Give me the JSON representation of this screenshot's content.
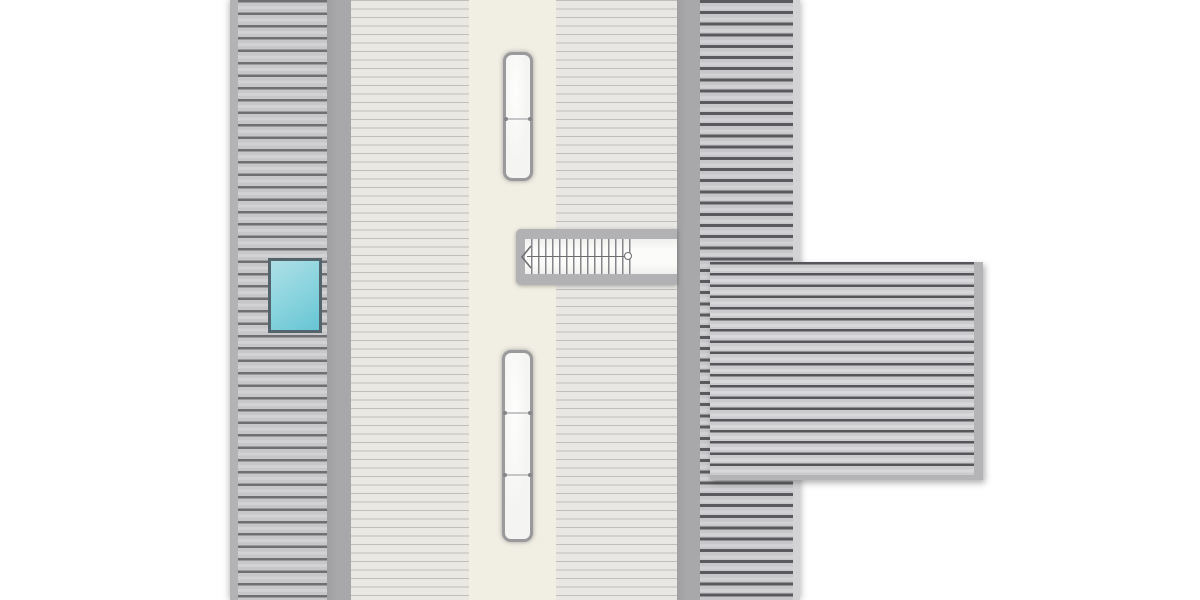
{
  "document": {
    "kind": "architectural-roof-plan",
    "description": "Top-down roof plan of a T-shaped house: long gabled main roof with ridge running vertically, hatched left and right slopes, a side wing roof extending right, one cyan skylight on the left slope, two white ridge roof-windows, and a staircase symbol with walkline, start circle and direction arrow.",
    "visible_text": []
  },
  "colors": {
    "canvas_bg": "#ffffff",
    "eave_left": "#b3b3b5",
    "eave_right": "#d3d3d5",
    "ridge_band_side": "#a8a8aa",
    "ridge_band_center": "#f1efe4",
    "slope_hatch_fill": "#c7c7c9",
    "slope_hatch_line": "#6f6f73",
    "slope_hatch_line_dark": "#5a5a5e",
    "cream_slope_fill": "#eae8e2",
    "cream_slope_fill2": "#e9e7e3",
    "cream_slope_line": "#c0beb8",
    "wing_fill": "#cbcbcd",
    "wing_line": "#56565a",
    "wing_edge": "#b4b4b6",
    "skylight_top": "#aedfe6",
    "skylight_bottom": "#66c5d4",
    "skylight_border": "#53646c",
    "window_fill": "#f4f4f2",
    "window_border": "#9a9a9c",
    "stair_band": "#b2b2b4",
    "stair_floor": "#fbfbf9",
    "stair_tread": "#85858a",
    "stair_walkline": "#6e6e72"
  },
  "plan": {
    "main_roof": {
      "strips_left_to_right": [
        "left-eave-band",
        "left-roof-slope-hatched",
        "left-ridge-band",
        "center-left-roof-slope",
        "center-ridge-band",
        "center-right-roof-slope",
        "right-ridge-band",
        "right-roof-slope-hatched",
        "right-eave-band"
      ]
    },
    "wing_roof": {
      "position": "right side, attached at stair level",
      "hatch": "horizontal"
    },
    "skylight": {
      "shape": "rectangle",
      "glazing": "cyan gradient",
      "location": "left roof slope"
    },
    "roof_window_upper": {
      "segments": 2,
      "dividers": 1
    },
    "roof_window_lower": {
      "segments": 3,
      "dividers": 2
    },
    "staircase": {
      "treads": 15,
      "walkline_end_marker": "circle",
      "direction_arrow": "points-left",
      "rails": [
        "top",
        "bottom"
      ],
      "left_cap": true
    }
  }
}
